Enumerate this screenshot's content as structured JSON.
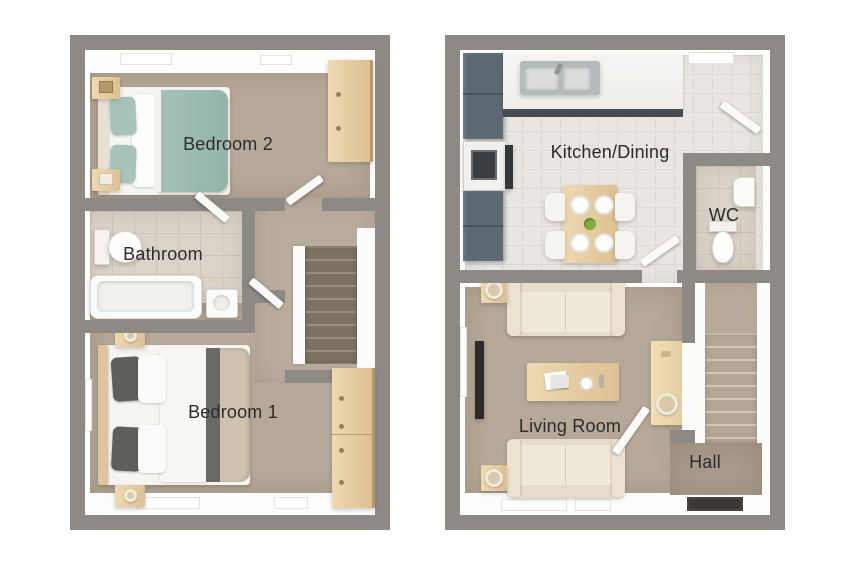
{
  "canvas": {
    "width": 850,
    "height": 567,
    "background": "#ffffff"
  },
  "plans": {
    "first_floor": {
      "rooms": {
        "bedroom2": {
          "label": "Bedroom 2"
        },
        "bathroom": {
          "label": "Bathroom"
        },
        "bedroom1": {
          "label": "Bedroom 1"
        }
      }
    },
    "ground_floor": {
      "rooms": {
        "kitchen_dining": {
          "label": "Kitchen/Dining"
        },
        "wc": {
          "label": "WC"
        },
        "living_room": {
          "label": "Living Room"
        },
        "hall": {
          "label": "Hall"
        }
      }
    }
  },
  "colors": {
    "wall_gray": "#8d8a85",
    "interior_white": "#fdfdfc",
    "carpet_taupe": "#b6a999",
    "bathroom_tile": "#dad3c9",
    "kitchen_tile": "#e9e6e2",
    "teal_bedding": "#9cbcb1",
    "light_wood": "#e2c9a0",
    "kitchen_units_slate": "#5c6972",
    "sofa_cream": "#ece3d3",
    "stair_dark": "#7d7365",
    "doormat_dark": "#3a3631",
    "label_text": "#2b2b2b"
  }
}
